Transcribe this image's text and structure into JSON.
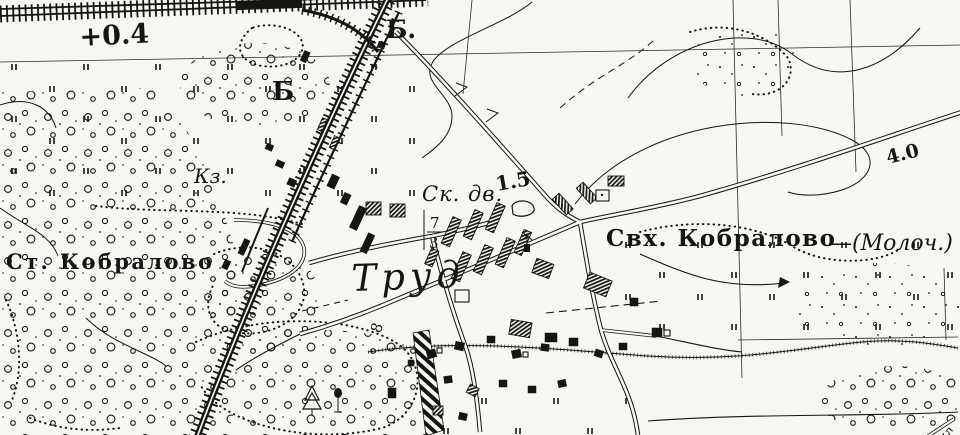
{
  "map": {
    "kind": "scanned-topographic-map",
    "colors": {
      "ink": "#17150f",
      "paper": "#f7f6f1"
    },
    "labels": [
      {
        "id": "spot-height",
        "text": "+0.4"
      },
      {
        "id": "railway-booth-top",
        "text": "Б."
      },
      {
        "id": "railway-booth-mid",
        "text": "Б"
      },
      {
        "id": "barracks-kz",
        "text": "Кз."
      },
      {
        "id": "cattle-yard",
        "text": "Ск. дв."
      },
      {
        "id": "depth-value",
        "text": "1.5"
      },
      {
        "id": "fraction-numerator",
        "text": "7"
      },
      {
        "id": "fraction-denominator",
        "text": "3"
      },
      {
        "id": "station-kobralovo",
        "text": "Ст. Кобралово"
      },
      {
        "id": "village-trud",
        "text": "Труд"
      },
      {
        "id": "sovkhoz-kobralovo",
        "text": "Свх. Кобралово"
      },
      {
        "id": "sovkhoz-type",
        "text": "—(Молоч.)"
      },
      {
        "id": "road-grade",
        "text": "4.0"
      },
      {
        "id": "plot-number-8",
        "text": "8"
      },
      {
        "id": "corner-number-5",
        "text": "5"
      }
    ]
  }
}
